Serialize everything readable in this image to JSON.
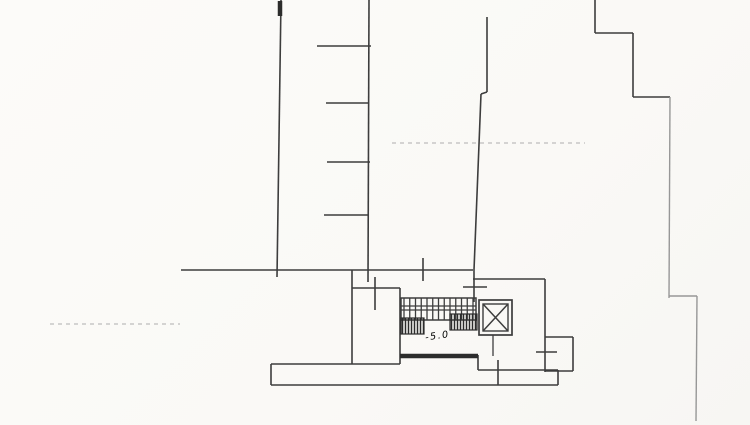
{
  "document": {
    "type": "scanned floor plan",
    "level_label": "-5.0"
  },
  "colors": {
    "background": "#fbfaf7",
    "ink": "#3d3d3d",
    "ink_thick": "#2c2c2c",
    "ink_light": "#979797",
    "ink_faint": "#bdbdbd"
  },
  "plan": {
    "layers": [
      {
        "name": "walls-dark",
        "color_key": "ink",
        "width": 1.6,
        "segments": [
          [
            281,
            0,
            277,
            277
          ],
          [
            369,
            0,
            368,
            282
          ],
          [
            317,
            46,
            371,
            46
          ],
          [
            326,
            103,
            369,
            103
          ],
          [
            327,
            162,
            370,
            162
          ],
          [
            324,
            215,
            368,
            215
          ],
          [
            487,
            17,
            487,
            92
          ],
          [
            487,
            92,
            481,
            94
          ],
          [
            481,
            94,
            474,
            270
          ],
          [
            474,
            270,
            474,
            302
          ],
          [
            463,
            287,
            487,
            287
          ],
          [
            181,
            270,
            473,
            270
          ],
          [
            473,
            279,
            545,
            279
          ],
          [
            545,
            279,
            545,
            372
          ],
          [
            423,
            258,
            423,
            281
          ],
          [
            352,
            270,
            352,
            364
          ],
          [
            271,
            364,
            400,
            364
          ],
          [
            271,
            364,
            271,
            385
          ],
          [
            271,
            385,
            558,
            385
          ],
          [
            558,
            370,
            558,
            385
          ],
          [
            478,
            370,
            558,
            370
          ],
          [
            478,
            355,
            478,
            370
          ],
          [
            352,
            288,
            400,
            288
          ],
          [
            375,
            277,
            375,
            310
          ],
          [
            400,
            288,
            400,
            364
          ],
          [
            545,
            337,
            573,
            337
          ],
          [
            573,
            337,
            573,
            371
          ],
          [
            545,
            371,
            573,
            371
          ],
          [
            536,
            352,
            557,
            352
          ],
          [
            498,
            360,
            498,
            385
          ],
          [
            595,
            0,
            595,
            33
          ],
          [
            595,
            33,
            633,
            33
          ],
          [
            633,
            33,
            633,
            97
          ],
          [
            633,
            97,
            670,
            97
          ]
        ]
      },
      {
        "name": "walls-thick",
        "color_key": "ink_thick",
        "width": 4.5,
        "segments": [
          [
            280,
            1,
            280,
            16
          ],
          [
            400,
            356,
            478,
            356
          ]
        ]
      },
      {
        "name": "walls-light",
        "color_key": "ink_light",
        "width": 1.4,
        "segments": [
          [
            670,
            97,
            669,
            298
          ],
          [
            669,
            296,
            697,
            296
          ],
          [
            697,
            296,
            696,
            421
          ]
        ]
      },
      {
        "name": "guides-dashed",
        "color_key": "ink_faint",
        "width": 1.2,
        "dash": "4 4",
        "segments": [
          [
            50,
            324,
            180,
            324
          ],
          [
            392,
            143,
            585,
            143
          ]
        ]
      }
    ],
    "stairs": {
      "box": {
        "x": 401,
        "y": 298,
        "w": 75,
        "h": 22
      },
      "tread_count": 13,
      "rail_offsets": [
        8,
        12
      ],
      "step_blocks": [
        {
          "x": 401,
          "y": 318,
          "w": 23,
          "h": 16
        },
        {
          "x": 450,
          "y": 314,
          "w": 27,
          "h": 16
        }
      ]
    },
    "elevator": {
      "outer": {
        "x": 479,
        "y": 300,
        "w": 33,
        "h": 35
      },
      "inner": {
        "x": 483,
        "y": 304,
        "w": 25,
        "h": 27
      },
      "stem": [
        493,
        335,
        493,
        356
      ]
    }
  }
}
